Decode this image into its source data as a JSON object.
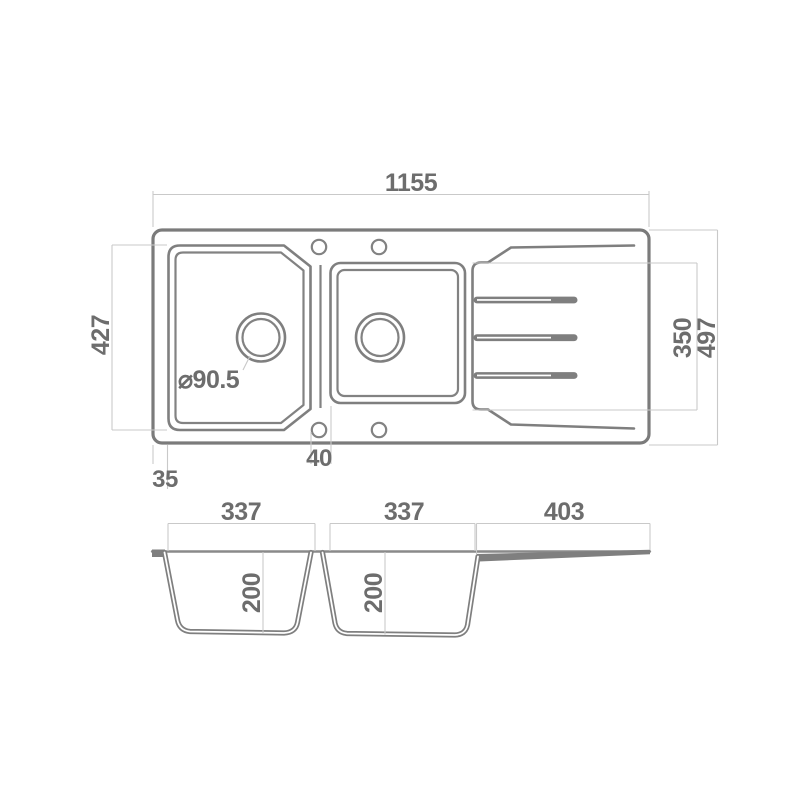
{
  "drawing": {
    "title": "double-bowl-sink-with-drainer-technical-drawing",
    "views": [
      "top-view",
      "section-view"
    ]
  },
  "top_view": {
    "dims": {
      "overall_width": "1155",
      "bowls_height": "427",
      "drainer_height": "350",
      "overall_depth": "497",
      "rim_offset": "35",
      "divider_width": "40",
      "drain_diameter": "⌀90.5"
    },
    "features": {
      "faucet_holes": 2,
      "mounting_holes": 2,
      "drain_grooves": 3,
      "bowls": 2
    }
  },
  "section_view": {
    "dims": {
      "bowl1_width": "337",
      "bowl2_width": "337",
      "drainer_width": "403",
      "bowl1_depth": "200",
      "bowl2_depth": "200"
    }
  },
  "colors": {
    "outline": "#7b7b7b",
    "dimension_line": "#c9c9c9",
    "text": "#6d6d6d",
    "background": "#ffffff"
  }
}
